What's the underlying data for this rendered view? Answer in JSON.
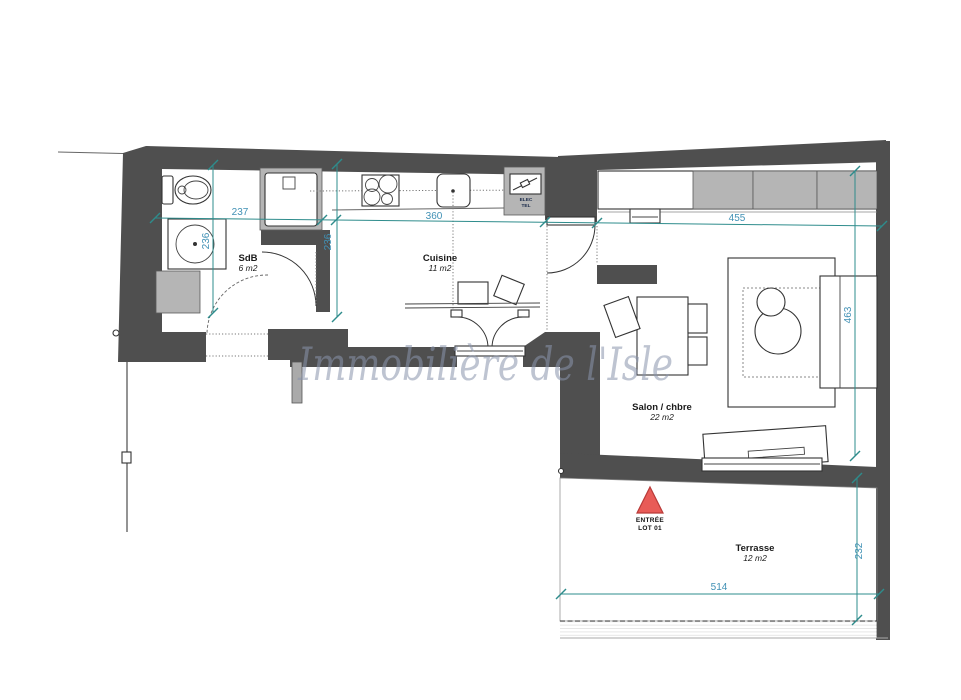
{
  "watermark": "Immobilière de l'Isle",
  "rooms": {
    "sdb": {
      "name": "SdB",
      "area": "6 m2"
    },
    "cuisine": {
      "name": "Cuisine",
      "area": "11 m2"
    },
    "salon": {
      "name": "Salon / chbre",
      "area": "22 m2"
    },
    "terrasse": {
      "name": "Terrasse",
      "area": "12 m2"
    }
  },
  "entrance": {
    "line1": "ENTRÉE",
    "line2": "LOT 01"
  },
  "utility_box": {
    "line1": "ELEC",
    "line2": "TEL"
  },
  "dimensions": {
    "sdb_width": "237",
    "sdb_depth": "236",
    "cuisine_width": "360",
    "cuisine_depth": "236",
    "salon_width": "455",
    "salon_depth": "463",
    "terrasse_width": "514",
    "terrasse_depth": "232"
  },
  "colors": {
    "wall": "#4f4f4f",
    "panel": "#b5b5b5",
    "dimension_line": "#2e8c8c",
    "dimension_text": "#4191b5",
    "entrance_marker": "#e85b57",
    "entrance_marker_border": "#b93a38",
    "watermark": "#8a94ad"
  }
}
